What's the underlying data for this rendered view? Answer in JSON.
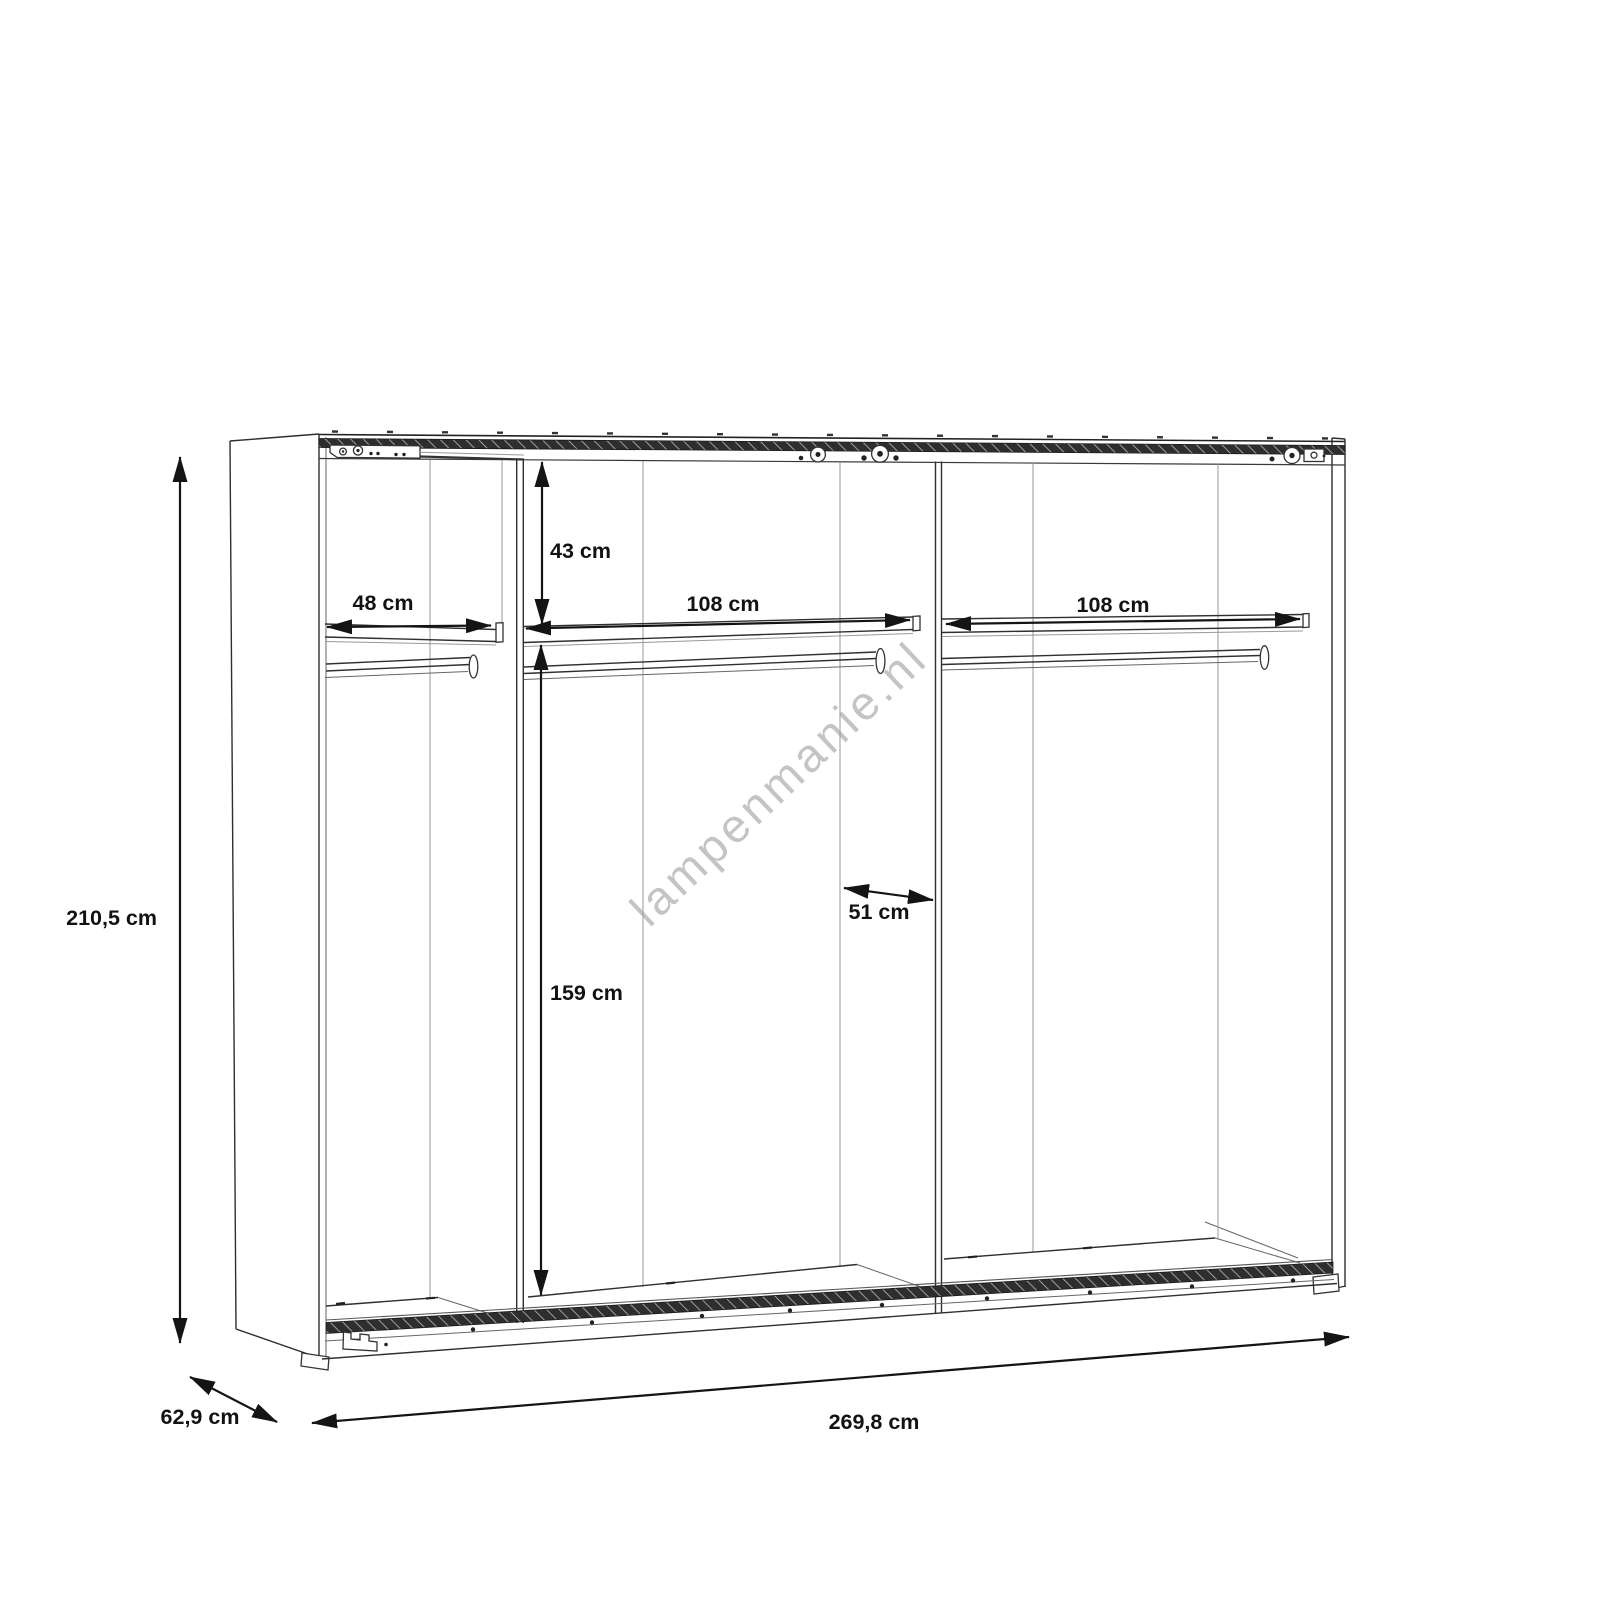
{
  "watermark": "lampenmanie.nl",
  "dimensions": {
    "height": "210,5 cm",
    "width": "269,8 cm",
    "depth": "62,9 cm",
    "left_shelf": "48 cm",
    "upper_section": "43 cm",
    "middle_shelf": "108 cm",
    "right_shelf": "108 cm",
    "inner_width": "51 cm",
    "lower_section": "159 cm"
  },
  "colors": {
    "background": "#ffffff",
    "line": "#2f2f2f",
    "light_line": "#999999",
    "dimension": "#141414",
    "rail_fill": "#2e2e2e",
    "rail_hatch": "#9f9f9f",
    "watermark": "#aeaeae"
  }
}
